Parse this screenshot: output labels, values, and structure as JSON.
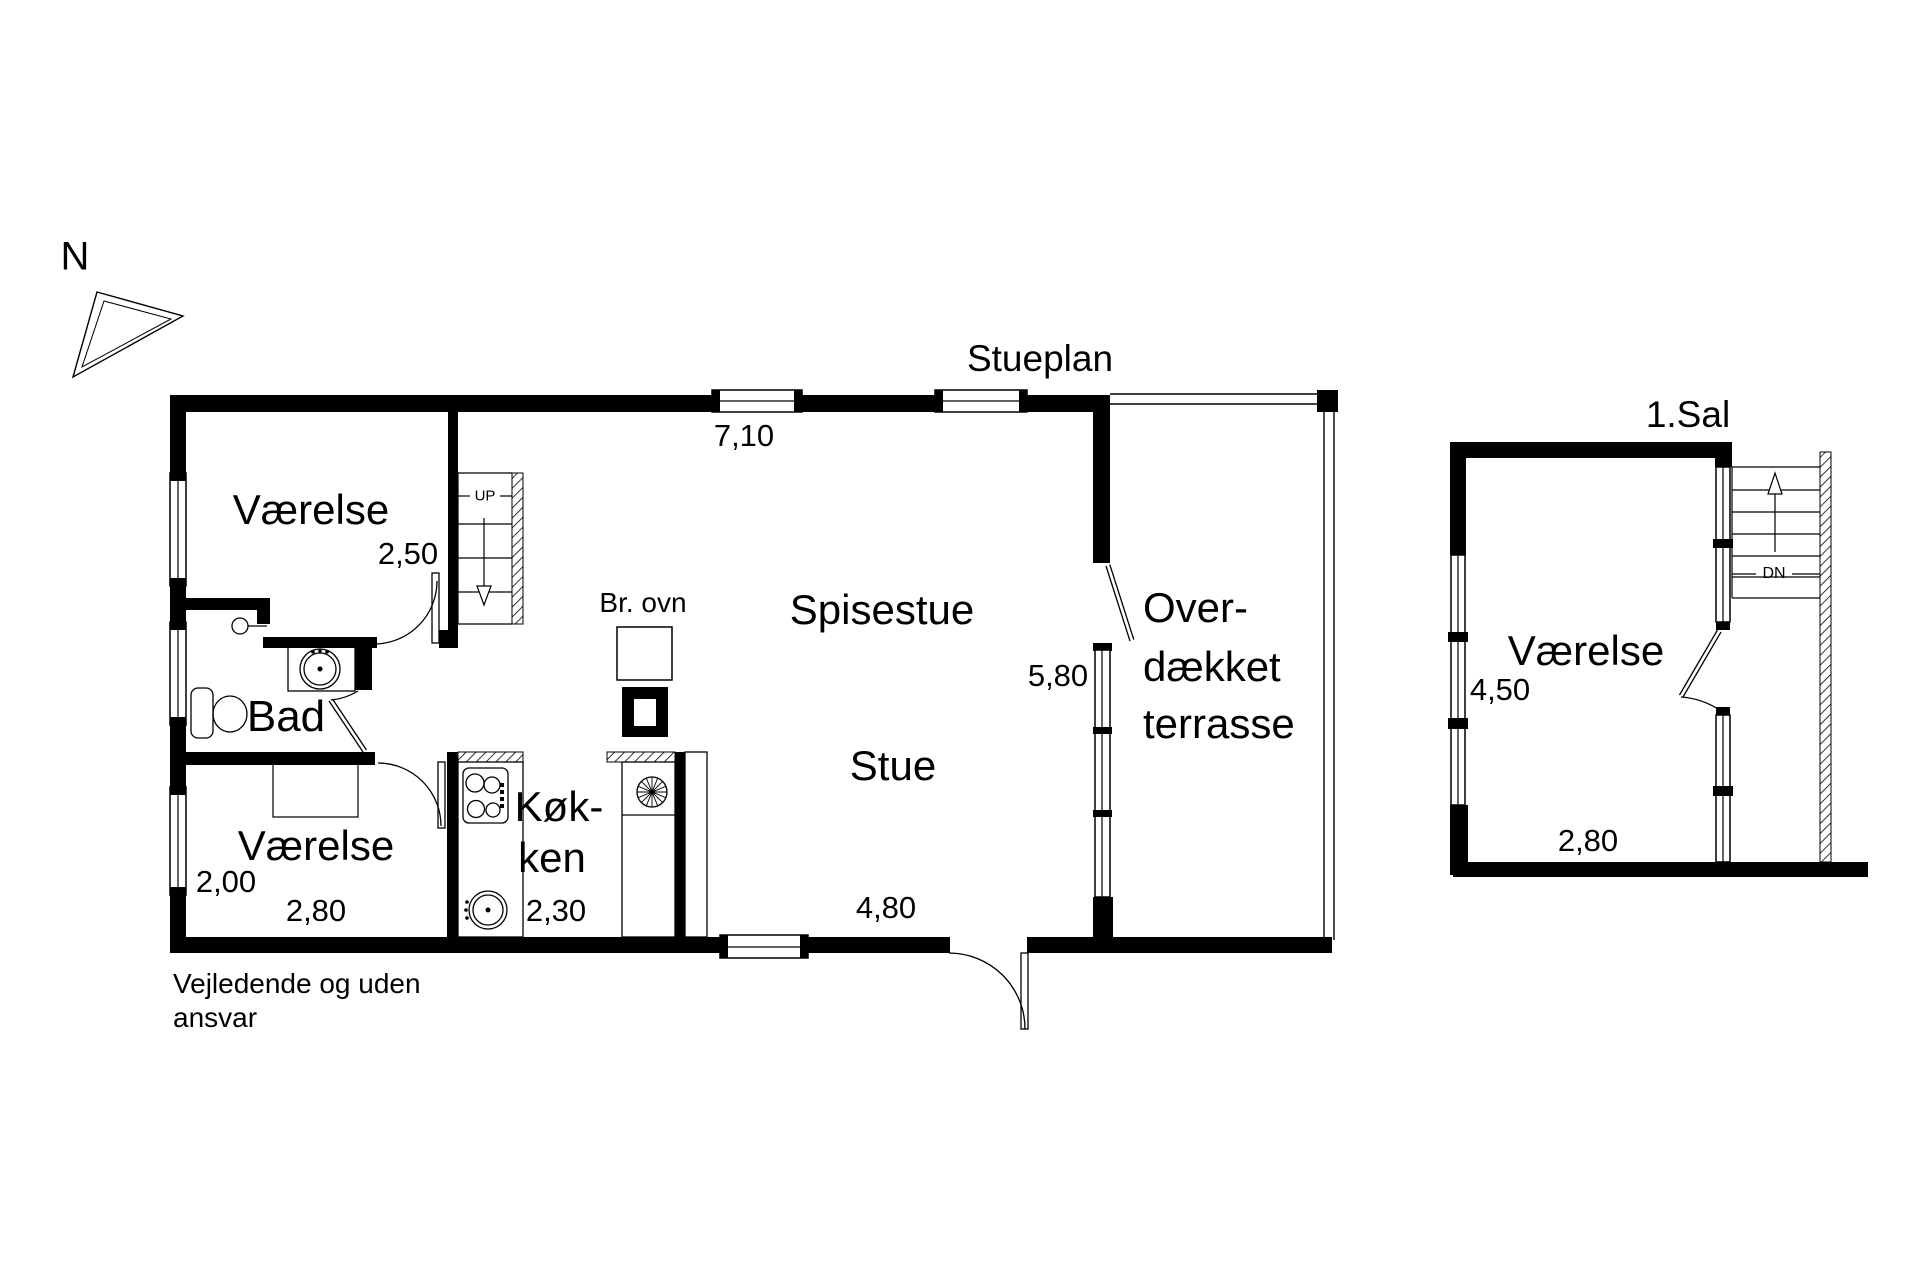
{
  "colors": {
    "ink": "#000000",
    "paper": "#ffffff"
  },
  "compass": {
    "north_label": "N"
  },
  "floor_plans": {
    "ground": {
      "title": "Stueplan",
      "bedroom_top": {
        "label": "Værelse",
        "width_dim": "2,50"
      },
      "bathroom": {
        "label": "Bad"
      },
      "bedroom_bottom": {
        "label": "Værelse",
        "depth_dim": "2,00",
        "width_dim": "2,80"
      },
      "kitchen": {
        "label_line1": "Køk-",
        "label_line2": "ken",
        "width_dim": "2,30"
      },
      "dining": {
        "label": "Spisestue"
      },
      "living": {
        "label": "Stue",
        "width_dim": "4,80"
      },
      "terrace": {
        "label_line1": "Over-",
        "label_line2": "dækket",
        "label_line3": "terrasse",
        "height_dim": "5,80"
      },
      "top_dim": "7,10",
      "wood_stove_label": "Br. ovn",
      "stairs_label": "UP"
    },
    "first": {
      "title": "1.Sal",
      "bedroom": {
        "label": "Værelse",
        "depth_dim": "4,50",
        "width_dim": "2,80"
      },
      "stairs_label": "DN"
    }
  },
  "disclaimer": {
    "line1": "Vejledende og uden",
    "line2": "ansvar"
  }
}
